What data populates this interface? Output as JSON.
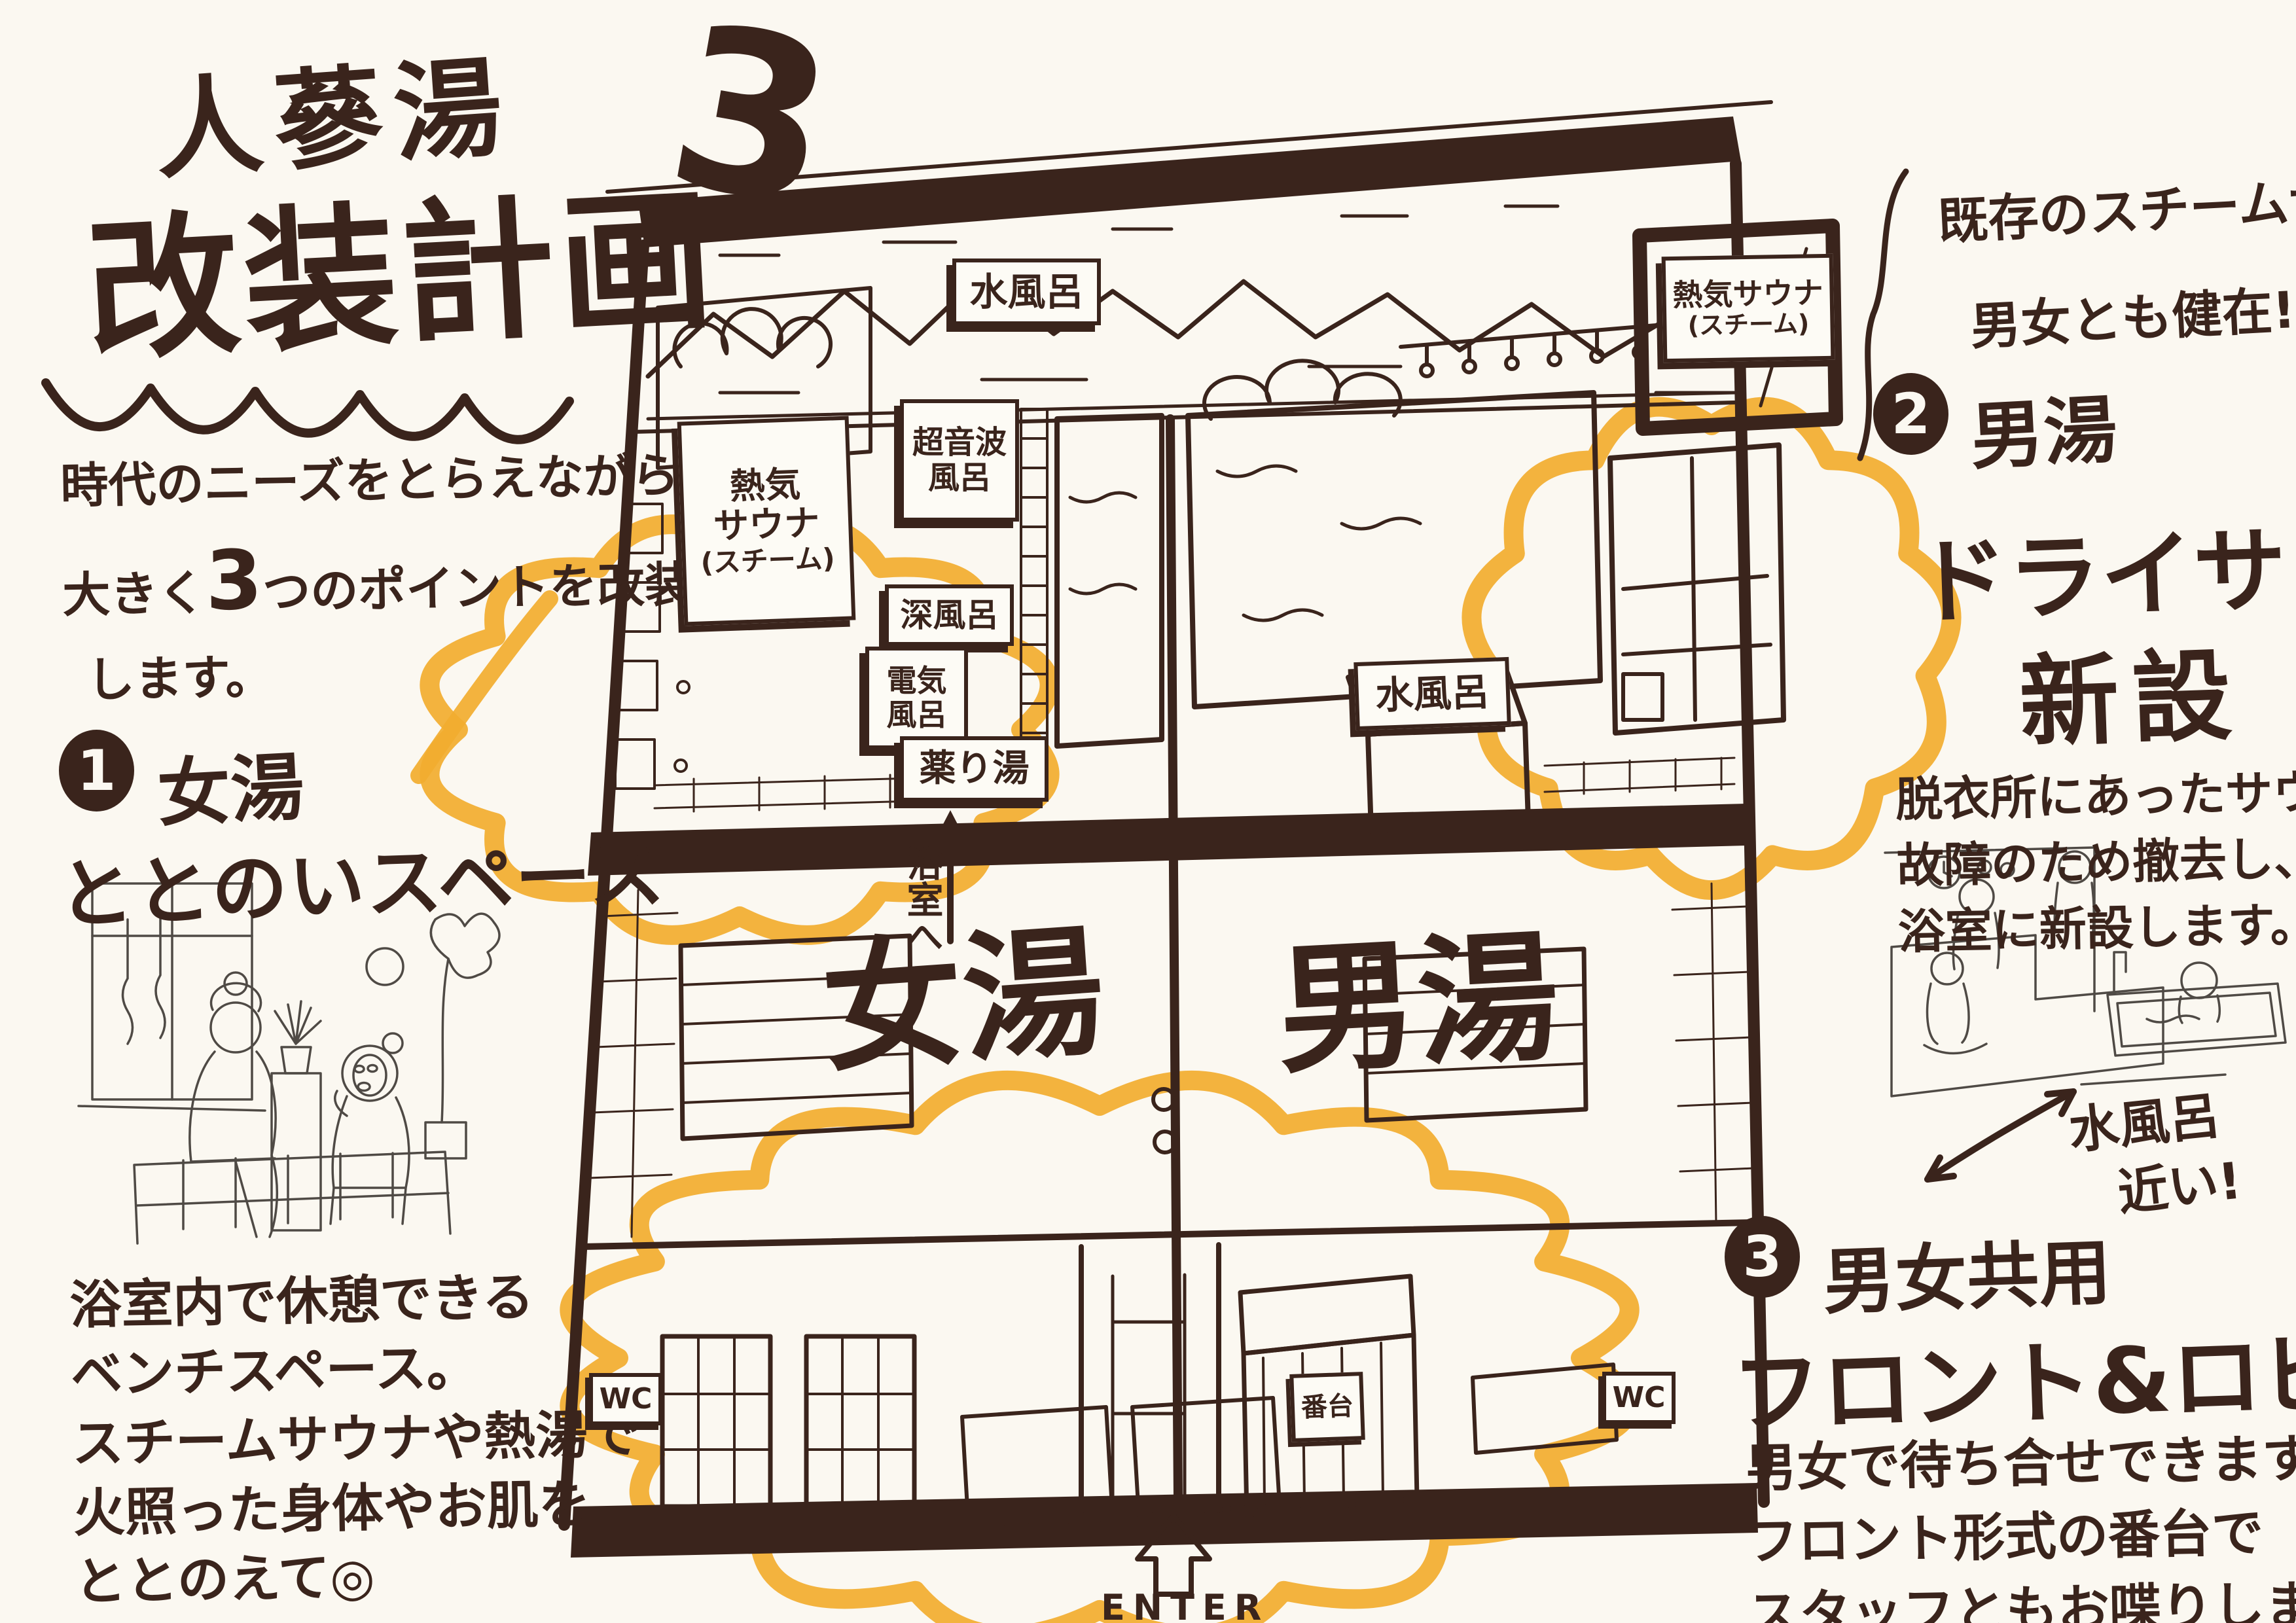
{
  "colors": {
    "bg": "#FBF8F1",
    "ink": "#3A241C",
    "sketch": "#4F4A45",
    "highlight": "#F2AC2F"
  },
  "title": {
    "name": "人蔘湯",
    "subtitle": "改装計画",
    "big_number": "3"
  },
  "intro": {
    "line1": "時代のニーズをとらえながら、",
    "line2_pre": "大きく",
    "line2_num": "3",
    "line2_post": "つのポイントを改装",
    "line3": "します。"
  },
  "point1": {
    "number": "1",
    "category": "女湯",
    "heading": "ととのいスペース",
    "desc": [
      "浴室内で休憩できる",
      "ベンチスペース。",
      "スチームサウナや熱湯で",
      "火照った身体やお肌を",
      "ととのえて◎"
    ]
  },
  "point2": {
    "number": "2",
    "category": "男湯",
    "heading1": "ドライサウナ",
    "heading2": "新設",
    "note1": "既存のスチームサウナも",
    "note2": "男女とも健在!",
    "desc": [
      "脱衣所にあったサウナは",
      "故障のため撤去し、",
      "浴室に新設します。"
    ],
    "annotation1": "水風呂",
    "annotation2": "近い!"
  },
  "point3": {
    "number": "3",
    "category": "男女共用",
    "heading": "フロント&ロビー",
    "desc": [
      "男女で待ち合せできます◎",
      "フロント形式の番台で",
      "スタッフともお喋りしましょう!"
    ]
  },
  "floorplan": {
    "zone_female": "女湯",
    "zone_male": "男湯",
    "sign_cold_bath_left": "水風呂",
    "sign_steam_sauna_left": [
      "熱気",
      "サウナ",
      "(スチーム)"
    ],
    "sign_ultrasonic": [
      "超音波",
      "風呂"
    ],
    "sign_deep_bath": "深風呂",
    "sign_electric": [
      "電気",
      "風呂"
    ],
    "sign_medicine_bath": "薬り湯",
    "to_bathroom": "浴室へ",
    "sign_cold_bath_right": "水風呂",
    "sign_steam_sauna_right": [
      "熱気サウナ",
      "(スチーム)"
    ],
    "wc_left": "WC",
    "bandai": "番台",
    "wc_right": "WC",
    "enter": "ENTER"
  }
}
